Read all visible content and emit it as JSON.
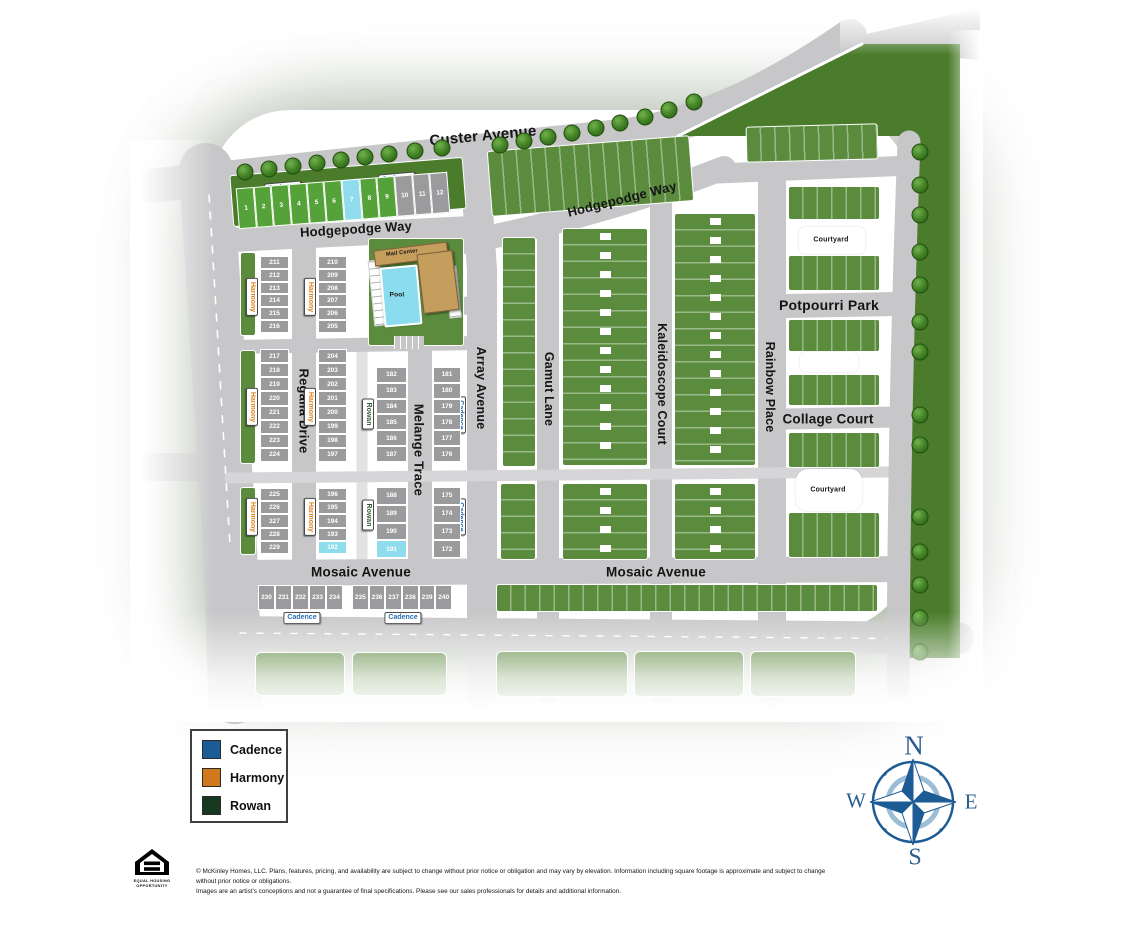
{
  "phases": {
    "cadence": "Cadence",
    "harmony": "Harmony",
    "rowan": "Rowan"
  },
  "streets": {
    "custer": "Custer Avenue",
    "hodgepodge": "Hodgepodge Way",
    "regalia": "Regalia Drive",
    "melange": "Melange Trace",
    "array": "Array Avenue",
    "gamut": "Gamut Lane",
    "kaleidoscope": "Kaleidoscope Court",
    "rainbow": "Rainbow Place",
    "mosaic": "Mosaic Avenue"
  },
  "places": {
    "potpourri_park": "Potpourri Park",
    "collage_court": "Collage Court",
    "courtyard": "Courtyard",
    "mail_center": "Mail Center",
    "pool": "Pool"
  },
  "legend": {
    "items": [
      {
        "label": "Cadence",
        "color": "#1c5c94"
      },
      {
        "label": "Harmony",
        "color": "#d0791c"
      },
      {
        "label": "Rowan",
        "color": "#16381f"
      }
    ]
  },
  "compass": {
    "north": "N",
    "east": "E",
    "south": "S",
    "west": "W"
  },
  "footer": {
    "disclaimer_line1": "© McKinley Homes, LLC. Plans, features, pricing, and availability are subject to change without prior notice or obligation and may vary by elevation. Information including square footage is approximate and subject to change without prior notice or obligations.",
    "disclaimer_line2": "Images are an artist's conceptions and not a guarantee of final specifications. Please see our sales professionals for details and additional information.",
    "equal_housing_line1": "EQUAL HOUSING",
    "equal_housing_line2": "OPPORTUNITY"
  },
  "lot_status_colors": {
    "g": "#56a23a",
    "x": "#9b9b9d",
    "b": "#8edcec"
  },
  "lot_groups": [
    {
      "id": "lots-1-12",
      "x": 237,
      "y": 180,
      "w": 212,
      "h": 41,
      "rot": -4.5,
      "dir": "h",
      "lots": [
        {
          "n": "1",
          "c": "g"
        },
        {
          "n": "2",
          "c": "g"
        },
        {
          "n": "3",
          "c": "g"
        },
        {
          "n": "4",
          "c": "g"
        },
        {
          "n": "5",
          "c": "g"
        },
        {
          "n": "6",
          "c": "g"
        },
        {
          "n": "7",
          "c": "b"
        },
        {
          "n": "8",
          "c": "g"
        },
        {
          "n": "9",
          "c": "g"
        },
        {
          "n": "10",
          "c": "x"
        },
        {
          "n": "11",
          "c": "x"
        },
        {
          "n": "12",
          "c": "x"
        }
      ]
    },
    {
      "id": "lots-211-216",
      "x": 260,
      "y": 256,
      "w": 29,
      "h": 77,
      "rot": 0,
      "dir": "v",
      "lots": [
        {
          "n": "211",
          "c": "x"
        },
        {
          "n": "212",
          "c": "x"
        },
        {
          "n": "213",
          "c": "x"
        },
        {
          "n": "214",
          "c": "x"
        },
        {
          "n": "215",
          "c": "x"
        },
        {
          "n": "216",
          "c": "x"
        }
      ]
    },
    {
      "id": "lots-210-205",
      "x": 318,
      "y": 256,
      "w": 29,
      "h": 77,
      "rot": 0,
      "dir": "v",
      "lots": [
        {
          "n": "210",
          "c": "x"
        },
        {
          "n": "209",
          "c": "x"
        },
        {
          "n": "208",
          "c": "x"
        },
        {
          "n": "207",
          "c": "x"
        },
        {
          "n": "206",
          "c": "x"
        },
        {
          "n": "205",
          "c": "x"
        }
      ]
    },
    {
      "id": "lots-217-224",
      "x": 260,
      "y": 349,
      "w": 29,
      "h": 113,
      "rot": 0,
      "dir": "v",
      "lots": [
        {
          "n": "217",
          "c": "x"
        },
        {
          "n": "218",
          "c": "x"
        },
        {
          "n": "219",
          "c": "x"
        },
        {
          "n": "220",
          "c": "x"
        },
        {
          "n": "221",
          "c": "x"
        },
        {
          "n": "222",
          "c": "x"
        },
        {
          "n": "223",
          "c": "x"
        },
        {
          "n": "224",
          "c": "x"
        }
      ]
    },
    {
      "id": "lots-204-197",
      "x": 318,
      "y": 349,
      "w": 29,
      "h": 113,
      "rot": 0,
      "dir": "v",
      "lots": [
        {
          "n": "204",
          "c": "x"
        },
        {
          "n": "203",
          "c": "x"
        },
        {
          "n": "202",
          "c": "x"
        },
        {
          "n": "201",
          "c": "x"
        },
        {
          "n": "200",
          "c": "x"
        },
        {
          "n": "199",
          "c": "x"
        },
        {
          "n": "198",
          "c": "x"
        },
        {
          "n": "197",
          "c": "x"
        }
      ]
    },
    {
      "id": "lots-225-229",
      "x": 260,
      "y": 488,
      "w": 29,
      "h": 66,
      "rot": 0,
      "dir": "v",
      "lots": [
        {
          "n": "225",
          "c": "x"
        },
        {
          "n": "226",
          "c": "x"
        },
        {
          "n": "227",
          "c": "x"
        },
        {
          "n": "228",
          "c": "x"
        },
        {
          "n": "229",
          "c": "x"
        }
      ]
    },
    {
      "id": "lots-196-192",
      "x": 318,
      "y": 488,
      "w": 29,
      "h": 66,
      "rot": 0,
      "dir": "v",
      "lots": [
        {
          "n": "196",
          "c": "x"
        },
        {
          "n": "195",
          "c": "x"
        },
        {
          "n": "194",
          "c": "x"
        },
        {
          "n": "193",
          "c": "x"
        },
        {
          "n": "192",
          "c": "b"
        }
      ]
    },
    {
      "id": "lots-182-187",
      "x": 376,
      "y": 367,
      "w": 31,
      "h": 95,
      "rot": 0,
      "dir": "v",
      "lots": [
        {
          "n": "182",
          "c": "x"
        },
        {
          "n": "183",
          "c": "x"
        },
        {
          "n": "184",
          "c": "x"
        },
        {
          "n": "185",
          "c": "x"
        },
        {
          "n": "186",
          "c": "x"
        },
        {
          "n": "187",
          "c": "x"
        }
      ]
    },
    {
      "id": "lots-181-176",
      "x": 433,
      "y": 367,
      "w": 28,
      "h": 95,
      "rot": 0,
      "dir": "v",
      "lots": [
        {
          "n": "181",
          "c": "x"
        },
        {
          "n": "180",
          "c": "x"
        },
        {
          "n": "179",
          "c": "x"
        },
        {
          "n": "178",
          "c": "x"
        },
        {
          "n": "177",
          "c": "x"
        },
        {
          "n": "176",
          "c": "x"
        }
      ]
    },
    {
      "id": "lots-188-191",
      "x": 376,
      "y": 487,
      "w": 31,
      "h": 71,
      "rot": 0,
      "dir": "v",
      "lots": [
        {
          "n": "188",
          "c": "x"
        },
        {
          "n": "189",
          "c": "x"
        },
        {
          "n": "190",
          "c": "x"
        },
        {
          "n": "191",
          "c": "b"
        }
      ]
    },
    {
      "id": "lots-175-172",
      "x": 433,
      "y": 487,
      "w": 28,
      "h": 71,
      "rot": 0,
      "dir": "v",
      "lots": [
        {
          "n": "175",
          "c": "x"
        },
        {
          "n": "174",
          "c": "x"
        },
        {
          "n": "173",
          "c": "x"
        },
        {
          "n": "172",
          "c": "x"
        }
      ]
    },
    {
      "id": "lots-230-234",
      "x": 258,
      "y": 585,
      "w": 85,
      "h": 25,
      "rot": 0,
      "dir": "h",
      "lots": [
        {
          "n": "230",
          "c": "x"
        },
        {
          "n": "231",
          "c": "x"
        },
        {
          "n": "232",
          "c": "x"
        },
        {
          "n": "233",
          "c": "x"
        },
        {
          "n": "234",
          "c": "x"
        }
      ]
    },
    {
      "id": "lots-235-240",
      "x": 352,
      "y": 585,
      "w": 100,
      "h": 25,
      "rot": 0,
      "dir": "h",
      "lots": [
        {
          "n": "235",
          "c": "x"
        },
        {
          "n": "236",
          "c": "x"
        },
        {
          "n": "237",
          "c": "x"
        },
        {
          "n": "238",
          "c": "x"
        },
        {
          "n": "239",
          "c": "x"
        },
        {
          "n": "240",
          "c": "x"
        }
      ]
    }
  ]
}
